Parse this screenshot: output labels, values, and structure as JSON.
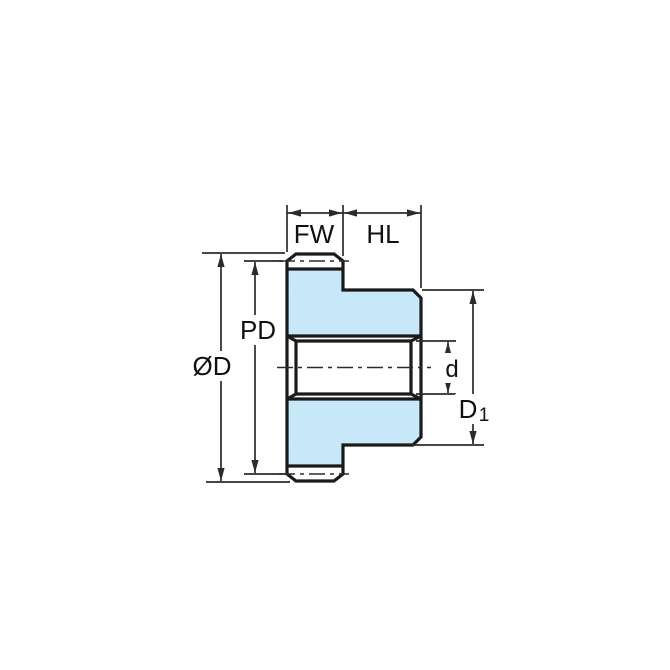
{
  "drawing": {
    "description": "Spur gear with hub, side cross-section technical drawing with dimension annotations",
    "labels": {
      "face_width": "FW",
      "hub_length": "HL",
      "pitch_diameter": "PD",
      "outside_diameter": "ØD",
      "bore_diameter": "d",
      "hub_diameter_main": "D",
      "hub_diameter_sub": "1"
    },
    "colors": {
      "body_fill": "#c6e8f8",
      "bore_fill": "#ffffff",
      "outline": "#1a1a1a",
      "dimension_lines": "#2b2b2b",
      "background": "#ffffff"
    }
  }
}
